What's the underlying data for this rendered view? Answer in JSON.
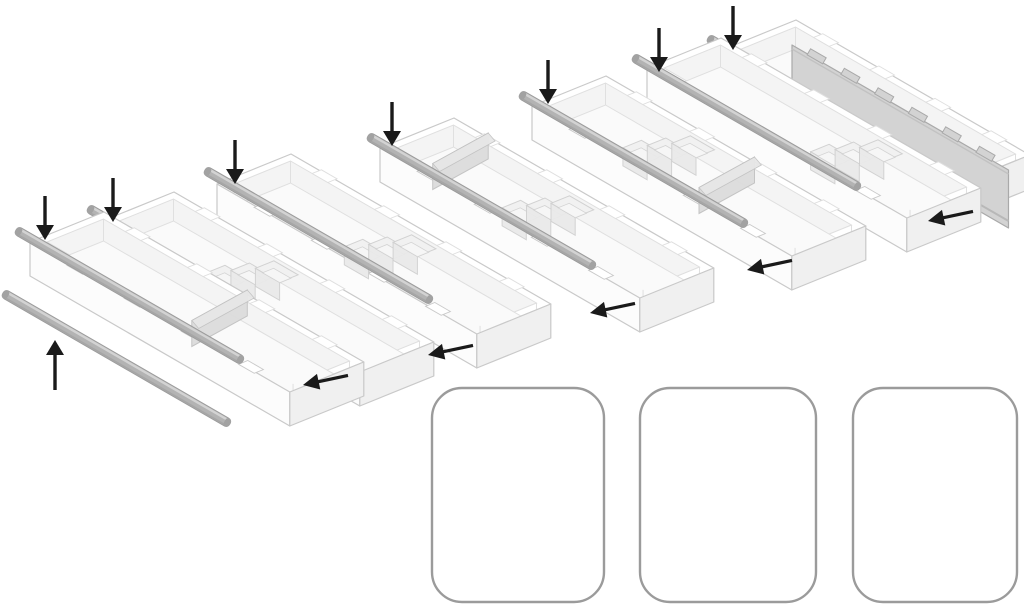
{
  "canvas": {
    "width": 1024,
    "height": 613,
    "background": "#ffffff"
  },
  "colors": {
    "arrow": "#1a1a1a",
    "rail": "#b3b3b3",
    "rail_edge": "#9a9a9a",
    "rail_highlight": "#d8d8d8",
    "rail_cap": "#a2a2a2",
    "outline": "#c9c9c9",
    "outline_soft": "#dfdfdf",
    "face": "#fcfcfc",
    "end_face": "#f0f0f0",
    "inner": "#f4f4f4",
    "floor": "#fafafa",
    "divider": "#dcdcdc",
    "divider_edge": "#c2c2c2",
    "bin": "#f1f1f1",
    "bin_edge": "#d0d0d0",
    "panel": "#d3d3d3",
    "panel_edge": "#a9a9a9",
    "panel_flange": "#b8b8b8",
    "callout_border": "#9b9b9b",
    "profile": "#c9c9c9",
    "profile_edge": "#9e9e9e",
    "clip": "#c4c4c4",
    "clip_edge": "#939393",
    "clip_stem": "#d2d2d2",
    "shade": "#e7e7e7",
    "faint": "#cfcfcf",
    "white": "#ffffff"
  },
  "iso": {
    "u": [
      0.866,
      0.5
    ],
    "v": [
      0.925,
      -0.375
    ],
    "rail_length": 262,
    "rail_thickness": 9,
    "tray_length": 300,
    "tray_width": 80,
    "tray_height": 34,
    "rotation_deg": 30
  },
  "trays": [
    {
      "name": "tray-7",
      "x": 722,
      "y": 50,
      "length": 270,
      "divider_at": null,
      "bins_at": null
    },
    {
      "name": "tray-6",
      "x": 647,
      "y": 68,
      "length": 300,
      "divider_at": null,
      "bins_at": 0.58
    },
    {
      "name": "tray-5",
      "x": 532,
      "y": 106,
      "length": 300,
      "divider_at": 0.6,
      "bins_at": 0.3
    },
    {
      "name": "tray-4",
      "x": 380,
      "y": 148,
      "length": 300,
      "divider_at": 0.16,
      "bins_at": 0.42
    },
    {
      "name": "tray-3",
      "x": 217,
      "y": 184,
      "length": 300,
      "divider_at": null,
      "bins_at": 0.44
    },
    {
      "name": "tray-2",
      "x": 100,
      "y": 222,
      "length": 300,
      "divider_at": null,
      "bins_at": 0.36
    },
    {
      "name": "tray-1",
      "x": 30,
      "y": 242,
      "length": 300,
      "divider_at": 0.58,
      "bins_at": null
    }
  ],
  "rails": [
    {
      "name": "rail-7",
      "x": 708,
      "y": 38
    },
    {
      "name": "rail-6",
      "x": 633,
      "y": 57
    },
    {
      "name": "rail-5",
      "x": 520,
      "y": 94
    },
    {
      "name": "rail-4",
      "x": 368,
      "y": 136
    },
    {
      "name": "rail-3",
      "x": 205,
      "y": 170
    },
    {
      "name": "rail-2",
      "x": 88,
      "y": 208
    },
    {
      "name": "rail-1",
      "x": 16,
      "y": 230
    },
    {
      "name": "front-rail-loose",
      "x": 3,
      "y": 293
    }
  ],
  "panel": {
    "name": "end-panel",
    "x": 792,
    "y": 45,
    "length": 250,
    "height": 58,
    "bumps": 6
  },
  "arrows": {
    "down": [
      {
        "name": "press-down-arrow-1",
        "x": 45,
        "y": 240
      },
      {
        "name": "press-down-arrow-2",
        "x": 113,
        "y": 222
      },
      {
        "name": "press-down-arrow-3",
        "x": 235,
        "y": 184
      },
      {
        "name": "press-down-arrow-4",
        "x": 392,
        "y": 146
      },
      {
        "name": "press-down-arrow-5",
        "x": 548,
        "y": 104
      },
      {
        "name": "press-down-arrow-6",
        "x": 659,
        "y": 72
      },
      {
        "name": "press-down-arrow-7",
        "x": 733,
        "y": 50
      }
    ],
    "left": [
      {
        "name": "slide-left-arrow-1",
        "x": 303,
        "y": 385
      },
      {
        "name": "slide-left-arrow-2",
        "x": 428,
        "y": 355
      },
      {
        "name": "slide-left-arrow-3",
        "x": 590,
        "y": 313
      },
      {
        "name": "slide-left-arrow-4",
        "x": 747,
        "y": 270
      },
      {
        "name": "slide-left-arrow-5",
        "x": 928,
        "y": 221
      }
    ],
    "up": [
      {
        "name": "push-up-arrow",
        "x": 55,
        "y": 340
      }
    ],
    "down_length": 44,
    "left_length": 46,
    "up_length": 50,
    "left_angle_deg": -12
  },
  "callouts": [
    {
      "name": "detail-front-rail-hook",
      "type": "front",
      "x": 432,
      "y": 388,
      "w": 172,
      "h": 214,
      "r": 30
    },
    {
      "name": "detail-clip-mount-top",
      "type": "clip-rim",
      "x": 640,
      "y": 388,
      "w": 176,
      "h": 214,
      "r": 30
    },
    {
      "name": "detail-clip-mount-side",
      "type": "clip-panel",
      "x": 853,
      "y": 388,
      "w": 164,
      "h": 214,
      "r": 30
    }
  ]
}
